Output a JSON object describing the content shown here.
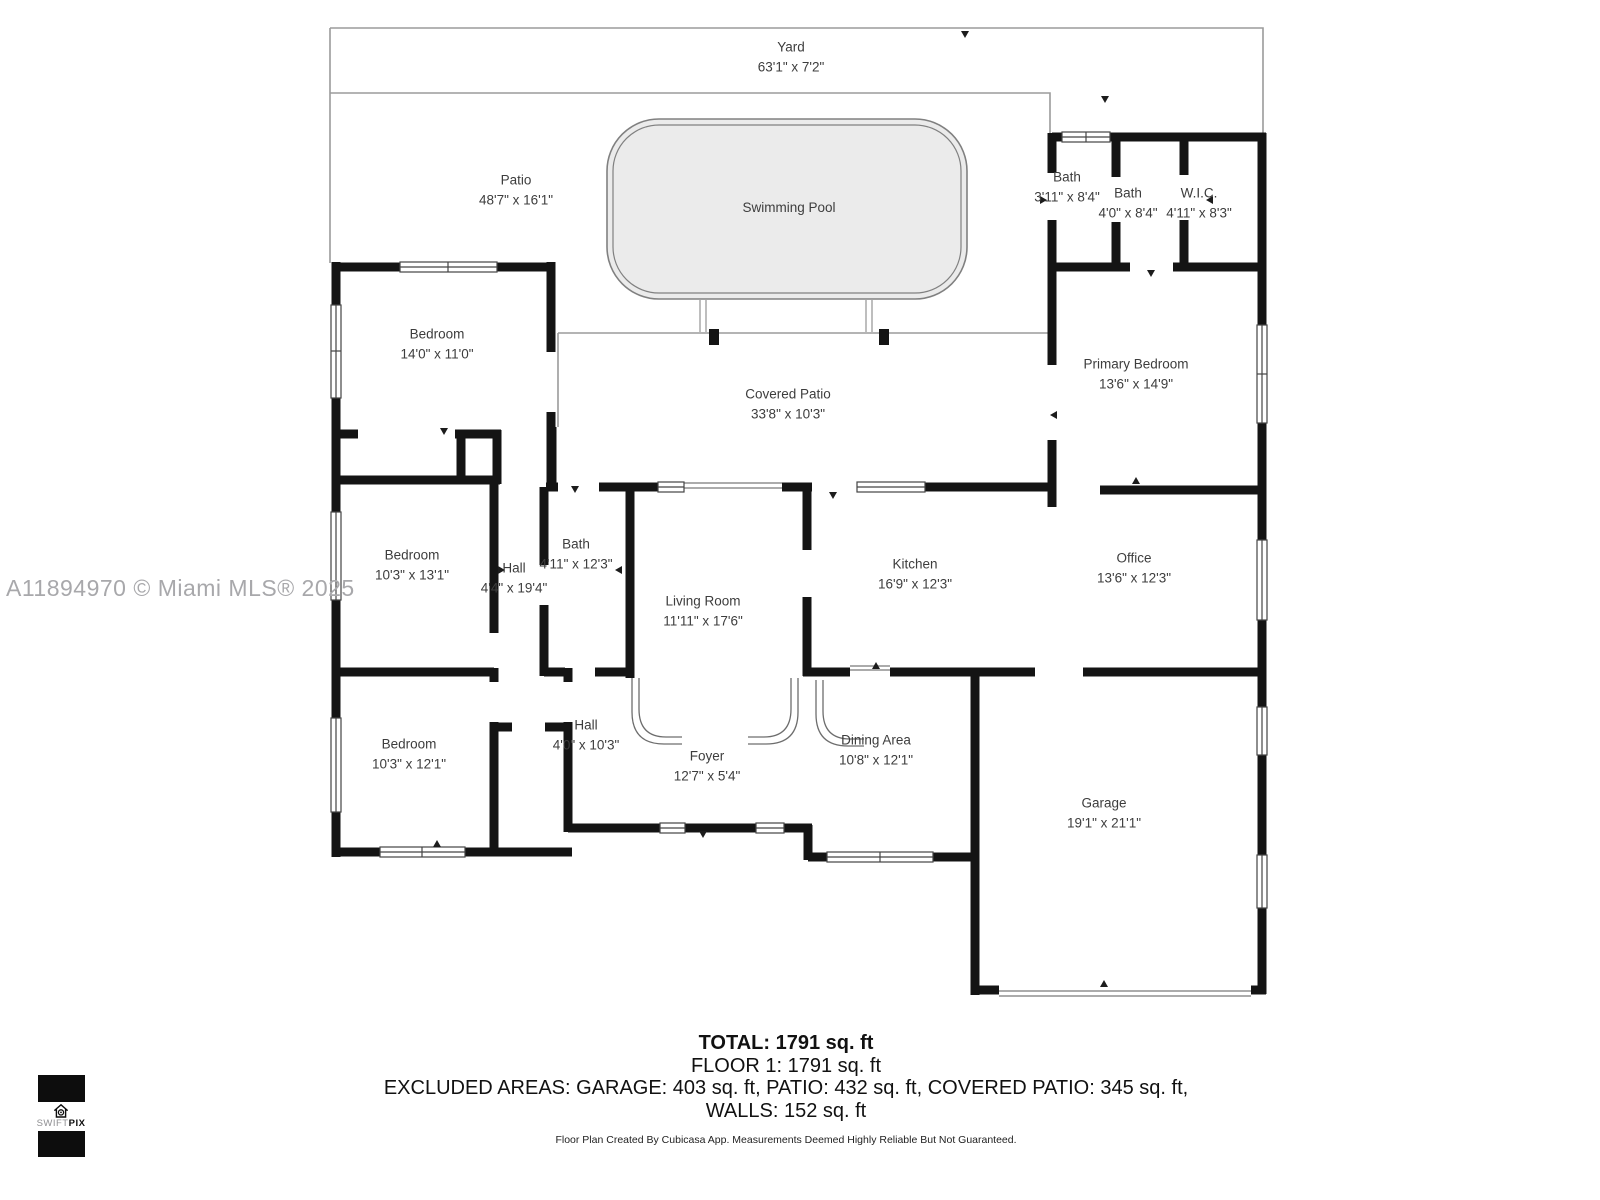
{
  "watermark": "A11894970 © Miami MLS® 2025",
  "rooms": [
    {
      "id": "yard",
      "name": "Yard",
      "dims": "63'1\" x 7'2\""
    },
    {
      "id": "patio",
      "name": "Patio",
      "dims": "48'7\" x 16'1\""
    },
    {
      "id": "swimming-pool",
      "name": "Swimming Pool",
      "dims": ""
    },
    {
      "id": "bath-top-1",
      "name": "Bath",
      "dims": "3'11\" x 8'4\""
    },
    {
      "id": "bath-top-2",
      "name": "Bath",
      "dims": "4'0\" x 8'4\""
    },
    {
      "id": "wic",
      "name": "W.I.C.",
      "dims": "4'11\" x 8'3\""
    },
    {
      "id": "bedroom-1",
      "name": "Bedroom",
      "dims": "14'0\" x 11'0\""
    },
    {
      "id": "primary-bedroom",
      "name": "Primary Bedroom",
      "dims": "13'6\" x 14'9\""
    },
    {
      "id": "covered-patio",
      "name": "Covered Patio",
      "dims": "33'8\" x 10'3\""
    },
    {
      "id": "bedroom-2",
      "name": "Bedroom",
      "dims": "10'3\" x 13'1\""
    },
    {
      "id": "hall-vertical",
      "name": "Hall",
      "dims": "4'4\" x 19'4\""
    },
    {
      "id": "bath-center",
      "name": "Bath",
      "dims": "4'11\" x 12'3\""
    },
    {
      "id": "living-room",
      "name": "Living Room",
      "dims": "11'11\" x 17'6\""
    },
    {
      "id": "kitchen",
      "name": "Kitchen",
      "dims": "16'9\" x 12'3\""
    },
    {
      "id": "office",
      "name": "Office",
      "dims": "13'6\" x 12'3\""
    },
    {
      "id": "bedroom-3",
      "name": "Bedroom",
      "dims": "10'3\" x 12'1\""
    },
    {
      "id": "hall-horizontal",
      "name": "Hall",
      "dims": "4'0\" x 10'3\""
    },
    {
      "id": "foyer",
      "name": "Foyer",
      "dims": "12'7\" x 5'4\""
    },
    {
      "id": "dining-area",
      "name": "Dining Area",
      "dims": "10'8\" x 12'1\""
    },
    {
      "id": "garage",
      "name": "Garage",
      "dims": "19'1\" x 21'1\""
    }
  ],
  "summary": {
    "total": "TOTAL: 1791 sq. ft",
    "floor": "FLOOR 1: 1791 sq. ft",
    "excluded": "EXCLUDED AREAS: GARAGE: 403 sq. ft, PATIO: 432 sq. ft, COVERED PATIO: 345 sq. ft,",
    "walls": "WALLS: 152 sq. ft",
    "disclaimer": "Floor Plan Created By Cubicasa App. Measurements Deemed Highly Reliable But Not Guaranteed."
  },
  "logo": {
    "brand_light": "SWIFT",
    "brand_bold": "PIX"
  },
  "colors": {
    "wall": "#141414",
    "thin_outline": "#9b9b9b",
    "pool_fill": "#ebebeb",
    "pool_stroke": "#808080",
    "label_text": "#3d3d3d",
    "watermark_text": "#a8a8ab"
  }
}
